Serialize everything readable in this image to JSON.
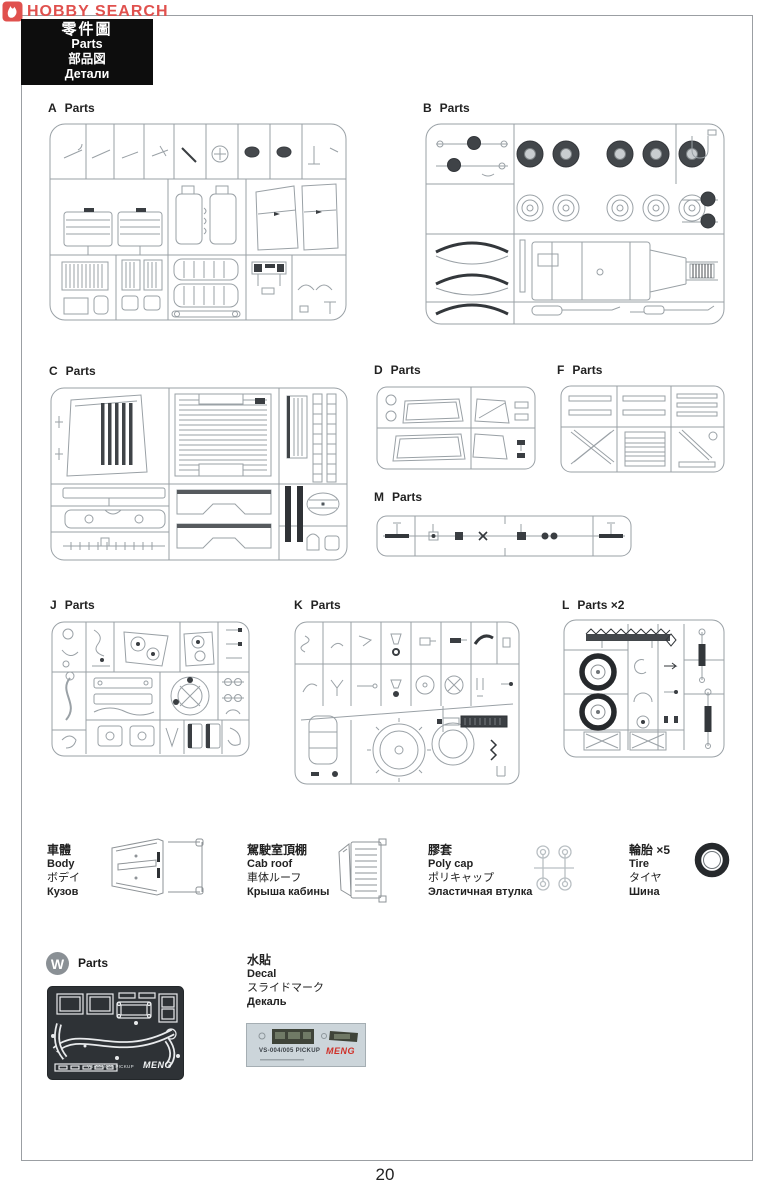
{
  "page": {
    "number": "20"
  },
  "logo": {
    "brand": "HOBBY SEARCH"
  },
  "header_box": {
    "line1": "零件圖",
    "line2": "Parts",
    "line3": "部品図",
    "line4": "Детали"
  },
  "sprues": [
    {
      "letter": "A",
      "word": "Parts"
    },
    {
      "letter": "B",
      "word": "Parts"
    },
    {
      "letter": "C",
      "word": "Parts"
    },
    {
      "letter": "D",
      "word": "Parts"
    },
    {
      "letter": "F",
      "word": "Parts"
    },
    {
      "letter": "M",
      "word": "Parts"
    },
    {
      "letter": "J",
      "word": "Parts"
    },
    {
      "letter": "K",
      "word": "Parts"
    },
    {
      "letter": "L",
      "word": "Parts ×2"
    }
  ],
  "loose": [
    {
      "lines": [
        "車體",
        "Body",
        "ボデイ",
        "Кузов"
      ]
    },
    {
      "lines": [
        "駕駛室頂棚",
        "Cab roof",
        "車体ルーフ",
        "Крыша кабины"
      ]
    },
    {
      "lines": [
        "膠套",
        "Poly cap",
        "ポリキャップ",
        "Эластичная втулка"
      ]
    },
    {
      "lines": [
        "輪胎 ×5",
        "Tire",
        "タイヤ",
        "Шина"
      ]
    }
  ],
  "w_section": {
    "badge": "W",
    "word": "Parts",
    "fret_text": "VS-004/005 PICKUP",
    "fret_brand": "MENG"
  },
  "decal": {
    "lines": [
      "水貼",
      "Decal",
      "スライドマーク",
      "Декаль"
    ],
    "sheet_text": "VS-004/005 PICKUP",
    "brand": "MENG"
  },
  "colors": {
    "accent_red": "#e0514e",
    "meng_red": "#cf3028",
    "line_grey": "#9aa1a6",
    "dark_part": "#3a3e42"
  }
}
